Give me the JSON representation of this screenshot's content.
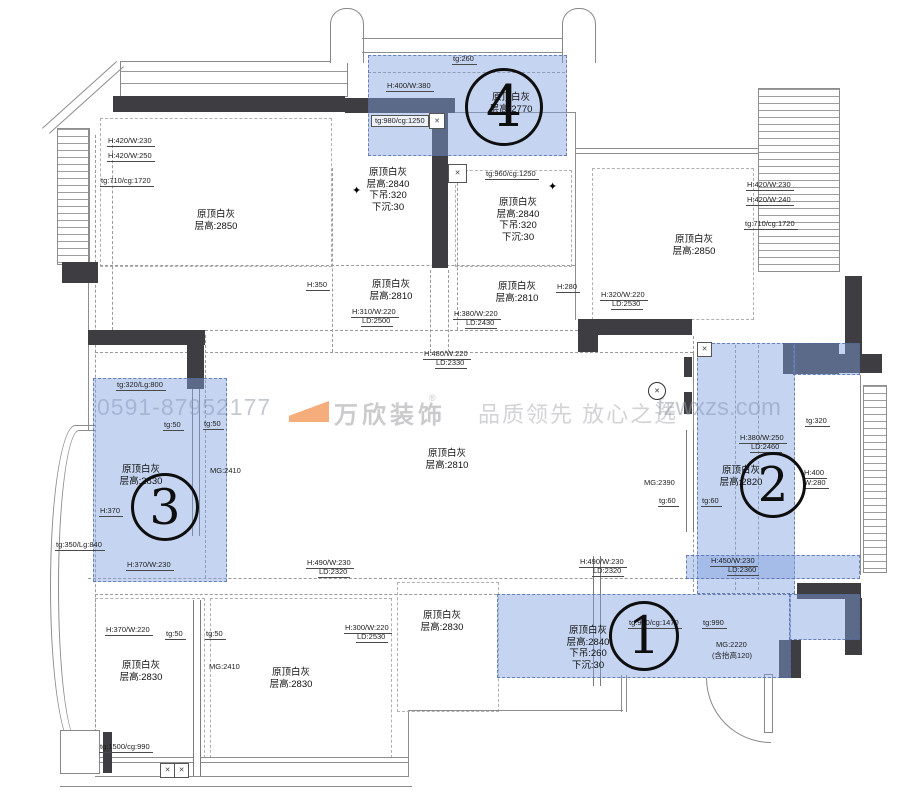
{
  "watermark": {
    "phone": "0591-87952177",
    "brand": "万欣装饰",
    "registered": "®",
    "slogan": "品质领先 放心之选",
    "site": "fzwxzs.com"
  },
  "room_labels": [
    {
      "lines": [
        "原顶白灰",
        "层高:2850"
      ],
      "x": 216,
      "y": 209
    },
    {
      "lines": [
        "原顶白灰",
        "层高:2840",
        "下吊:320",
        "下沉:30"
      ],
      "x": 388,
      "y": 167
    },
    {
      "lines": [
        "原顶白灰",
        "层高:2840",
        "下吊:320",
        "下沉:30"
      ],
      "x": 518,
      "y": 197
    },
    {
      "lines": [
        "原顶白灰",
        "层高:2850"
      ],
      "x": 694,
      "y": 234
    },
    {
      "lines": [
        "原顶白灰",
        "层高:2810"
      ],
      "x": 391,
      "y": 279
    },
    {
      "lines": [
        "原顶白灰",
        "层高:2810"
      ],
      "x": 517,
      "y": 281
    },
    {
      "lines": [
        "原顶白灰",
        "层高:2770"
      ],
      "x": 511,
      "y": 92
    },
    {
      "lines": [
        "原顶白灰",
        "层高:2830"
      ],
      "x": 141,
      "y": 464
    },
    {
      "lines": [
        "原顶白灰",
        "层高:2810"
      ],
      "x": 447,
      "y": 448
    },
    {
      "lines": [
        "原顶白灰",
        "层高:2820"
      ],
      "x": 741,
      "y": 465
    },
    {
      "lines": [
        "原顶白灰",
        "层高:2840",
        "下吊:260",
        "下沉:30"
      ],
      "x": 588,
      "y": 625
    },
    {
      "lines": [
        "原顶白灰",
        "层高:2830"
      ],
      "x": 141,
      "y": 660
    },
    {
      "lines": [
        "原顶白灰",
        "层高:2830"
      ],
      "x": 291,
      "y": 667
    },
    {
      "lines": [
        "原顶白灰",
        "层高:2830"
      ],
      "x": 442,
      "y": 610
    }
  ],
  "dim_labels": [
    {
      "t": "H:420/W:230",
      "x": 107,
      "y": 137
    },
    {
      "t": "H:420/W:250",
      "x": 107,
      "y": 152
    },
    {
      "t": "tg:710/cg:1720",
      "x": 100,
      "y": 177
    },
    {
      "t": "tg:260",
      "x": 452,
      "y": 55
    },
    {
      "t": "H:400/W:380",
      "x": 386,
      "y": 82
    },
    {
      "t": "tg:980/cg:1250",
      "x": 371,
      "y": 115,
      "boxed": true
    },
    {
      "t": "tg:960/cg:1250",
      "x": 485,
      "y": 170
    },
    {
      "t": "H:420/W:230",
      "x": 746,
      "y": 181
    },
    {
      "t": "H:420/W:240",
      "x": 746,
      "y": 196
    },
    {
      "t": "tg:710/cg:1720",
      "x": 744,
      "y": 220
    },
    {
      "t": "H:350",
      "x": 306,
      "y": 281
    },
    {
      "t": "H:310/W:220",
      "x": 351,
      "y": 308
    },
    {
      "t": "LD:2500",
      "x": 361,
      "y": 317
    },
    {
      "t": "H:380/W:220",
      "x": 453,
      "y": 310
    },
    {
      "t": "LD:2430",
      "x": 465,
      "y": 319
    },
    {
      "t": "H:280",
      "x": 556,
      "y": 283
    },
    {
      "t": "H:320/W:220",
      "x": 600,
      "y": 291
    },
    {
      "t": "LD:2530",
      "x": 611,
      "y": 300
    },
    {
      "t": "H:480/W:220",
      "x": 423,
      "y": 350
    },
    {
      "t": "LD:2330",
      "x": 435,
      "y": 359
    },
    {
      "t": "tg:320/Lg:800",
      "x": 116,
      "y": 381
    },
    {
      "t": "tg:50",
      "x": 163,
      "y": 421
    },
    {
      "t": "tg:50",
      "x": 203,
      "y": 420
    },
    {
      "t": "MG:2410",
      "x": 210,
      "y": 467,
      "ul": false
    },
    {
      "t": "H:370",
      "x": 99,
      "y": 507
    },
    {
      "t": "tg:350/Lg:840",
      "x": 55,
      "y": 541
    },
    {
      "t": "H:370/W:230",
      "x": 126,
      "y": 561
    },
    {
      "t": "H:490/W:230",
      "x": 306,
      "y": 559
    },
    {
      "t": "LD:2320",
      "x": 318,
      "y": 568
    },
    {
      "t": "H:490/W:230",
      "x": 579,
      "y": 558
    },
    {
      "t": "LD:2320",
      "x": 592,
      "y": 567
    },
    {
      "t": "H:450/W:230",
      "x": 710,
      "y": 557
    },
    {
      "t": "LD:2360",
      "x": 727,
      "y": 566
    },
    {
      "t": "tg:320",
      "x": 805,
      "y": 417
    },
    {
      "t": "H:380/W:250",
      "x": 739,
      "y": 434
    },
    {
      "t": "LD:2460",
      "x": 750,
      "y": 443
    },
    {
      "t": "H:400",
      "x": 803,
      "y": 469
    },
    {
      "t": "W:280",
      "x": 803,
      "y": 479
    },
    {
      "t": "MG:2390",
      "x": 644,
      "y": 479,
      "ul": false
    },
    {
      "t": "tg:60",
      "x": 658,
      "y": 497
    },
    {
      "t": "tg:60",
      "x": 701,
      "y": 497
    },
    {
      "t": "tg:950/cg:1470",
      "x": 628,
      "y": 619
    },
    {
      "t": "tg:990",
      "x": 702,
      "y": 619
    },
    {
      "t": "MG:2220",
      "x": 716,
      "y": 641,
      "ul": false
    },
    {
      "t": "(含抬高120)",
      "x": 712,
      "y": 652,
      "ul": false
    },
    {
      "t": "H:300/W:220",
      "x": 344,
      "y": 624
    },
    {
      "t": "LD:2530",
      "x": 356,
      "y": 633
    },
    {
      "t": "H:370/W:220",
      "x": 105,
      "y": 626
    },
    {
      "t": "tg:50",
      "x": 165,
      "y": 630
    },
    {
      "t": "tg:50",
      "x": 205,
      "y": 630
    },
    {
      "t": "MG:2410",
      "x": 209,
      "y": 663,
      "ul": false
    },
    {
      "t": "tg:1500/cg:990",
      "x": 99,
      "y": 743
    }
  ],
  "region_circles": [
    {
      "n": "1",
      "x": 644,
      "y": 636,
      "r": 35
    },
    {
      "n": "2",
      "x": 773,
      "y": 485,
      "r": 33
    },
    {
      "n": "3",
      "x": 165,
      "y": 507,
      "r": 34
    },
    {
      "n": "4",
      "x": 504,
      "y": 107,
      "r": 39
    }
  ],
  "symbols": {
    "light_cross": "✕",
    "star": "✦",
    "bell_cross": "✕"
  },
  "colors": {
    "highlight": "rgba(127,160,222,0.45)",
    "wall": "#3e3e42",
    "line": "#8d8d8d",
    "logo_orange": "#f5ad7c"
  }
}
